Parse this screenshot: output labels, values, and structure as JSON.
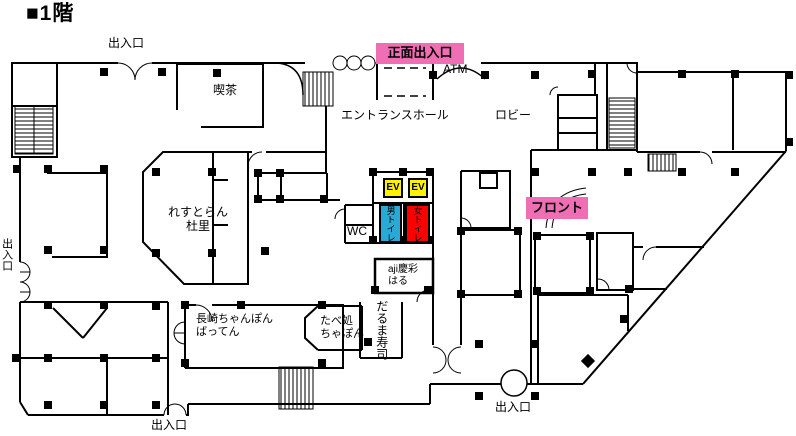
{
  "title": "■1階",
  "colors": {
    "wall": "#000000",
    "highlight_pink": "#f06eb4",
    "ev_yellow": "#fff100",
    "toilet_blue": "#29a9d6",
    "toilet_red": "#ff0000"
  },
  "entrances": {
    "top": "出入口",
    "main": "正面出入口",
    "left": "出入口",
    "bottom": "出入口",
    "bottom_right": "出入口"
  },
  "facilities": {
    "atm": "ATM",
    "entrance_hall": "エントランスホール",
    "lobby": "ロビー",
    "front_desk": "フロント",
    "wc": "WC",
    "elevator": "EV",
    "mens_toilet": "男トイレ",
    "womens_toilet": "女トイレ"
  },
  "shops": {
    "cafe": "喫茶",
    "restaurant": {
      "line1": "れすとらん",
      "line2": "杜里"
    },
    "nagasaki_champon": {
      "line1": "長崎ちゃんぽん",
      "line2": "ばってん"
    },
    "tabedokoro": {
      "line1": "たべ処",
      "line2": "ちゃぽん"
    },
    "daruma_sushi": "だるま寿司",
    "aji": {
      "line1": "aji慶彩",
      "line2": "はる"
    }
  }
}
